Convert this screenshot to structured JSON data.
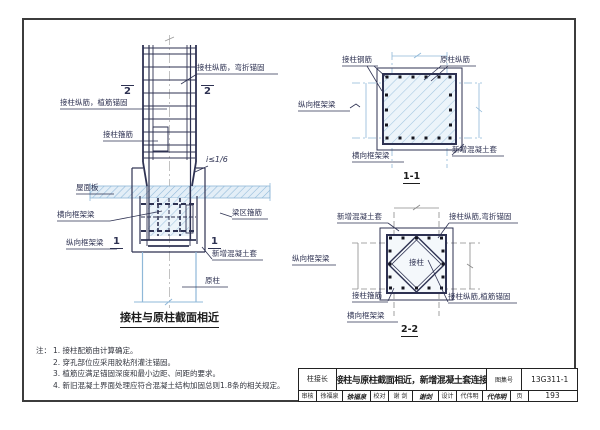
{
  "page": {
    "bg": "#ffffff",
    "frame_color": "#3c3c3c",
    "line_color": "#2e3252",
    "axis_blue": "#8fb8d8",
    "hatch_blue": "#a3c6e0",
    "axis_gray": "#8a8a8a"
  },
  "elevation": {
    "section_mark_2": "2",
    "section_mark_1": "1",
    "labels": {
      "bend_anchor": "接柱纵筋，弯折锚固",
      "planted_anchor": "接柱纵筋，植筋锚固",
      "column_stirrup": "接柱箍筋",
      "slope": "i≤1/6",
      "roof_slab": "屋面板",
      "transverse_beam": "横向框架梁",
      "beam_stirrup": "梁区箍筋",
      "longitudinal_beam": "纵向框架梁",
      "new_jacket": "新增混凝土套",
      "original_column": "原柱"
    },
    "title": "接柱与原柱截面相近"
  },
  "section_1_1": {
    "caption": "1-1",
    "labels": {
      "splice_rebar": "接柱钢筋",
      "orig_rebar": "原柱纵筋",
      "longitudinal_beam": "纵向框架梁",
      "transverse_beam": "横向框架梁",
      "new_jacket": "新增混凝土套"
    }
  },
  "section_2_2": {
    "caption": "2-2",
    "labels": {
      "new_jacket": "新增混凝土套",
      "bend_anchor": "接柱纵筋,弯折锚固",
      "longitudinal_beam": "纵向框架梁",
      "column_core": "接柱",
      "column_stirrup": "接柱箍筋",
      "planted_anchor": "接柱纵筋,植筋锚固",
      "transverse_beam": "横向框架梁"
    }
  },
  "notes": {
    "prefix": "注：",
    "items": [
      "1. 接柱配筋由计算确定。",
      "2. 穿孔部位应采用胶粘剂灌注锚固。",
      "3. 植筋应满足锚固深度和最小边距、间距的要求。",
      "4. 新旧混凝土界面处理应符合混凝土结构加固总则1.8条的相关规定。"
    ]
  },
  "title_block": {
    "category": "柱接长",
    "title": "接柱与原柱截面相近，新增混凝土套连接",
    "atlas_label": "图集号",
    "atlas_no": "13G311-1",
    "reviewer_label": "审核",
    "reviewer": "徐福泉",
    "reviewer_sig": "徐福泉",
    "checker_label": "校对",
    "checker": "谢 剑",
    "checker_sig": "谢剑",
    "designer_label": "设计",
    "designer": "代伟明",
    "designer_sig": "代伟明",
    "page_label": "页",
    "page_no": "193"
  }
}
